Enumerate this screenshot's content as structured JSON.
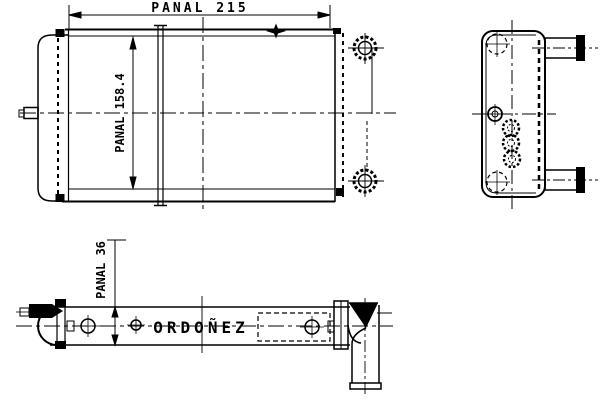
{
  "drawing": {
    "background_color": "#ffffff",
    "line_color": "#000000",
    "dimensions": {
      "width": {
        "label": "PANAL 215",
        "value": 215
      },
      "height": {
        "label": "PANAL 158.4",
        "value": 158.4
      },
      "depth": {
        "label": "PANAL 36",
        "value": 36
      }
    },
    "brand": {
      "label": "ORDOÑEZ"
    }
  }
}
